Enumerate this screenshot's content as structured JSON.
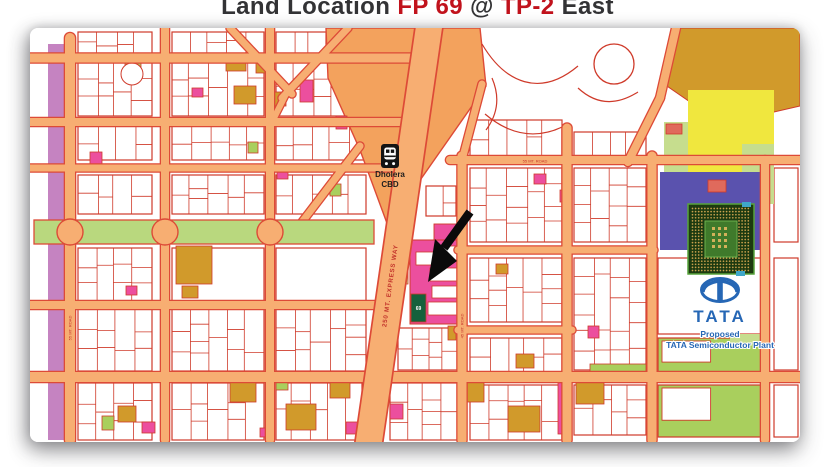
{
  "title": {
    "part1": "Land Location ",
    "part2": "FP 69",
    "part3": " @ ",
    "part4": "TP-2",
    "part5": " East"
  },
  "labels": {
    "cbd_line1": "Dholera",
    "cbd_line2": "CBD",
    "expressway": "250 MT.  EXPRESS WAY",
    "plot": "69",
    "tata": "TATA",
    "proposed": "Proposed",
    "plant": "TATA Semiconductor Plant",
    "road_left": "55 MT. ROAD",
    "road_right": "45 MT. ROAD",
    "road_top_right": "55 MT. ROAD"
  },
  "palette": {
    "road": "#f7ae72",
    "road_edge": "#dd4a37",
    "stroke": "#cf3a2a",
    "pink": "#ec4f9e",
    "green": "#a9cf5d",
    "lgreen": "#c6dd8e",
    "ochre": "#d19a2b",
    "yellow": "#f0e73e",
    "indigo": "#5a52ae",
    "salmon": "#e06a5c",
    "mauve": "#c583c1",
    "cbd": "#f3a25d",
    "blvd": "#b9d87e",
    "dgreen": "#15613c",
    "blue": "#2667b5",
    "label_red": "#c3342b",
    "black": "#111111",
    "white": "#ffffff"
  },
  "map": {
    "w": 770,
    "h": 414,
    "mauve_strip": [
      18,
      16,
      26,
      396
    ],
    "blocks": [
      [
        48,
        4,
        74,
        22,
        "s"
      ],
      [
        48,
        34,
        74,
        54,
        "s"
      ],
      [
        48,
        98,
        74,
        34,
        "s"
      ],
      [
        48,
        147,
        74,
        39,
        "s"
      ],
      [
        48,
        220,
        74,
        53,
        "s"
      ],
      [
        48,
        281,
        74,
        62,
        "s"
      ],
      [
        48,
        355,
        74,
        57,
        "s"
      ],
      [
        142,
        4,
        92,
        22,
        "s"
      ],
      [
        142,
        34,
        92,
        54,
        "s"
      ],
      [
        142,
        98,
        92,
        34,
        "s"
      ],
      [
        142,
        147,
        92,
        39,
        "s"
      ],
      [
        142,
        220,
        92,
        53,
        "p"
      ],
      [
        142,
        281,
        92,
        62,
        "s"
      ],
      [
        142,
        355,
        92,
        57,
        "s"
      ],
      [
        246,
        4,
        50,
        22,
        "s"
      ],
      [
        246,
        34,
        90,
        54,
        "s"
      ],
      [
        246,
        98,
        90,
        34,
        "s"
      ],
      [
        246,
        147,
        90,
        39,
        "s"
      ],
      [
        246,
        220,
        90,
        53,
        "p"
      ],
      [
        246,
        281,
        90,
        62,
        "s"
      ],
      [
        246,
        355,
        86,
        57,
        "s"
      ],
      [
        396,
        158,
        30,
        30,
        "s"
      ],
      [
        368,
        300,
        60,
        42,
        "s"
      ],
      [
        360,
        355,
        68,
        57,
        "s"
      ],
      [
        440,
        92,
        92,
        36,
        "s"
      ],
      [
        440,
        140,
        92,
        74,
        "s"
      ],
      [
        440,
        230,
        92,
        64,
        "s"
      ],
      [
        440,
        310,
        92,
        34,
        "s"
      ],
      [
        440,
        357,
        92,
        55,
        "s"
      ],
      [
        544,
        104,
        72,
        30,
        "s"
      ],
      [
        544,
        140,
        72,
        74,
        "s"
      ],
      [
        544,
        230,
        72,
        112,
        "s"
      ],
      [
        544,
        357,
        72,
        50,
        "s"
      ],
      [
        628,
        230,
        108,
        76,
        "p"
      ],
      [
        628,
        310,
        108,
        34,
        "g"
      ],
      [
        628,
        357,
        108,
        52,
        "g"
      ],
      [
        744,
        140,
        24,
        74,
        "p"
      ],
      [
        744,
        230,
        24,
        112,
        "p"
      ],
      [
        744,
        357,
        24,
        52,
        "p"
      ]
    ],
    "areas": {
      "cbd": [
        [
          296,
          0
        ],
        [
          450,
          0
        ],
        [
          456,
          58
        ],
        [
          358,
          198
        ],
        [
          330,
          122
        ],
        [
          298,
          50
        ]
      ],
      "ochre": [
        [
          644,
          0
        ],
        [
          770,
          0
        ],
        [
          770,
          78
        ],
        [
          692,
          96
        ],
        [
          634,
          56
        ]
      ],
      "yellow": [
        658,
        62,
        86,
        82
      ],
      "lgreen": [
        [
          634,
          94,
          24,
          80
        ],
        [
          712,
          116,
          32,
          60
        ],
        [
          700,
          306,
          36,
          10
        ]
      ],
      "indigo": [
        630,
        144,
        108,
        78
      ],
      "salmon": [
        [
          636,
          96,
          16,
          10
        ],
        [
          678,
          152,
          18,
          12
        ]
      ]
    },
    "village_paths": [
      "M452,16 C475,55 510,70 548,38",
      "M455,86 Q495,120 538,96",
      "M548,60 Q575,85 608,64",
      "M462,50 Q474,78 456,102"
    ],
    "village_circle": [
      584,
      36,
      20
    ],
    "plots": [
      [
        95,
        30,
        16,
        11,
        "g"
      ],
      [
        60,
        124,
        12,
        16,
        "p"
      ],
      [
        162,
        60,
        11,
        9,
        "p"
      ],
      [
        270,
        52,
        13,
        22,
        "p"
      ],
      [
        306,
        88,
        11,
        13,
        "p"
      ],
      [
        247,
        140,
        11,
        11,
        "p"
      ],
      [
        96,
        258,
        11,
        9,
        "p"
      ],
      [
        152,
        258,
        16,
        12,
        "o"
      ],
      [
        196,
        28,
        20,
        15,
        "o"
      ],
      [
        226,
        34,
        11,
        11,
        "o"
      ],
      [
        204,
        58,
        22,
        18,
        "o"
      ],
      [
        242,
        64,
        14,
        14,
        "o"
      ],
      [
        146,
        218,
        36,
        38,
        "o"
      ],
      [
        300,
        156,
        11,
        12,
        "g"
      ],
      [
        218,
        114,
        10,
        11,
        "g"
      ],
      [
        364,
        198,
        14,
        58,
        "l"
      ],
      [
        530,
        162,
        10,
        12,
        "p"
      ],
      [
        558,
        298,
        11,
        12,
        "p"
      ],
      [
        528,
        350,
        10,
        56,
        "p"
      ],
      [
        418,
        298,
        8,
        14,
        "o"
      ],
      [
        486,
        326,
        18,
        14,
        "o"
      ],
      [
        88,
        378,
        18,
        16,
        "o"
      ],
      [
        200,
        354,
        26,
        20,
        "o"
      ],
      [
        256,
        376,
        30,
        26,
        "o"
      ],
      [
        300,
        354,
        20,
        16,
        "o"
      ],
      [
        430,
        354,
        24,
        20,
        "o"
      ],
      [
        478,
        378,
        32,
        26,
        "o"
      ],
      [
        546,
        354,
        28,
        22,
        "o"
      ],
      [
        112,
        394,
        13,
        11,
        "p"
      ],
      [
        230,
        400,
        11,
        9,
        "p"
      ],
      [
        316,
        394,
        13,
        12,
        "p"
      ],
      [
        360,
        376,
        13,
        15,
        "p"
      ],
      [
        72,
        388,
        12,
        14,
        "g"
      ],
      [
        246,
        352,
        12,
        10,
        "g"
      ],
      [
        560,
        336,
        56,
        9,
        "g"
      ],
      [
        504,
        146,
        12,
        10,
        "p"
      ],
      [
        466,
        236,
        12,
        10,
        "o"
      ]
    ],
    "circle_plot": [
      102,
      46,
      11
    ],
    "pink_district": {
      "main": [
        380,
        212,
        54,
        84
      ],
      "wedge": [
        404,
        196,
        30,
        18
      ],
      "subs": [
        [
          386,
          224,
          20,
          13
        ],
        [
          410,
          218,
          20,
          14
        ],
        [
          400,
          240,
          32,
          13
        ],
        [
          402,
          258,
          32,
          12
        ],
        [
          398,
          274,
          36,
          13
        ]
      ],
      "plot69": [
        381,
        266,
        15,
        28
      ]
    },
    "roads_h": [
      [
        30,
        0,
        402,
        9
      ],
      [
        94,
        0,
        378,
        8
      ],
      [
        140,
        0,
        368,
        7
      ],
      [
        277,
        0,
        352,
        8
      ],
      [
        349,
        0,
        770,
        10
      ],
      [
        132,
        420,
        770,
        8
      ],
      [
        222,
        428,
        624,
        7
      ],
      [
        302,
        428,
        542,
        7
      ]
    ],
    "roads_v": [
      [
        40,
        10,
        412,
        10
      ],
      [
        135,
        0,
        412,
        8
      ],
      [
        240,
        0,
        412,
        8
      ],
      [
        432,
        128,
        412,
        9
      ],
      [
        537,
        100,
        412,
        9
      ],
      [
        622,
        128,
        412,
        9
      ],
      [
        735,
        132,
        412,
        8
      ]
    ],
    "roads_d": [
      [
        200,
        0,
        262,
        66,
        7
      ],
      [
        318,
        0,
        252,
        70,
        7
      ],
      [
        256,
        66,
        241,
        96,
        6
      ],
      [
        330,
        118,
        272,
        194,
        7
      ],
      [
        646,
        0,
        630,
        70,
        8
      ],
      [
        630,
        70,
        598,
        134,
        8
      ],
      [
        452,
        56,
        432,
        132,
        7
      ]
    ],
    "expressway": {
      "x1": 400,
      "y1": -8,
      "x2": 338,
      "y2": 420,
      "w": 26
    },
    "boulevard": {
      "x": 4,
      "y": 192,
      "w": 340,
      "h": 24,
      "roundabouts": [
        40,
        135,
        240
      ],
      "r": 13
    },
    "cbd_icon": [
      351,
      116,
      18,
      24
    ],
    "arrow": {
      "shaft": [
        440,
        184,
        414,
        220
      ],
      "head": [
        [
          398,
          254
        ],
        [
          427,
          233
        ],
        [
          405,
          211
        ]
      ]
    },
    "chip": {
      "x": 658,
      "y": 176,
      "w": 66,
      "h": 70
    },
    "logo": {
      "cx": 690,
      "cy": 262,
      "rx": 18.5,
      "ry": 11.5
    }
  }
}
